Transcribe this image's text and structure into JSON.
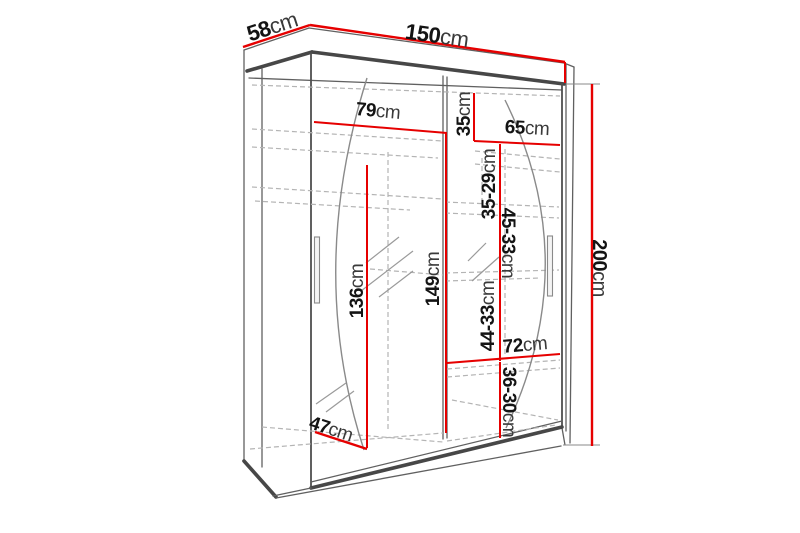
{
  "diagram": {
    "kind": "wardrobe-dimension-diagram",
    "colors": {
      "dimension_line": "#e60000",
      "outline": "#555555",
      "dashed_line": "#b4b4b4",
      "background": "#ffffff"
    },
    "dimensions": {
      "depth": {
        "value": "58",
        "unit": "cm"
      },
      "width": {
        "value": "150",
        "unit": "cm"
      },
      "height": {
        "value": "200",
        "unit": "cm"
      },
      "upper_left_width": {
        "value": "79",
        "unit": "cm"
      },
      "upper_shelf_height": {
        "value": "35",
        "unit": "cm"
      },
      "upper_right_width": {
        "value": "65",
        "unit": "cm"
      },
      "right_gap_top": {
        "value": "35-29",
        "unit": "cm"
      },
      "right_gap_middle": {
        "value": "45-33",
        "unit": "cm"
      },
      "left_height": {
        "value": "136",
        "unit": "cm"
      },
      "center_height": {
        "value": "149",
        "unit": "cm"
      },
      "right_gap_lower": {
        "value": "44-33",
        "unit": "cm"
      },
      "lower_right_width": {
        "value": "72",
        "unit": "cm"
      },
      "bottom_gap": {
        "value": "36-30",
        "unit": "cm"
      },
      "bottom_depth": {
        "value": "47",
        "unit": "cm"
      }
    }
  }
}
